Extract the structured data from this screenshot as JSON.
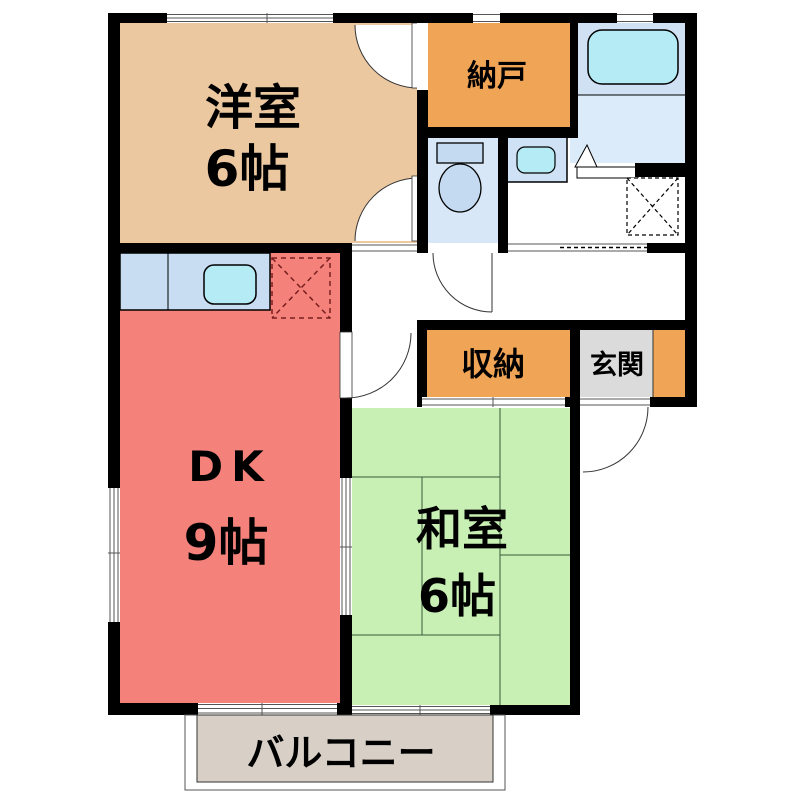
{
  "plan_title": "2DK apartment floor plan",
  "rooms": {
    "western": {
      "name": "洋室",
      "size": "6帖",
      "color": "#ecc8a1"
    },
    "storeroom": {
      "name": "納戸",
      "color": "#f0a456"
    },
    "dk": {
      "name": "DK",
      "size": "9帖",
      "color": "#f4827b"
    },
    "closet": {
      "name": "収納",
      "color": "#f0a456"
    },
    "entrance": {
      "name": "玄関",
      "color": "#dbdbdb"
    },
    "japanese": {
      "name": "和室",
      "size": "6帖",
      "color": "#c9f0b4"
    },
    "balcony": {
      "name": "バルコニー",
      "color": "#d8d0c7"
    }
  },
  "fixtures": {
    "bathtub": "bathtub",
    "toilet": "toilet",
    "washbasin": "washbasin",
    "kitchen_sink": "kitchen-sink-counter",
    "refrigerator_space": "refrigerator-space (dashed X)",
    "washing_machine_space": "washing-machine-space (dashed X)",
    "bath_door": "folding-bath-door"
  },
  "colors": {
    "wall": "#000000",
    "water_room_floor": "#d8e7f7",
    "bath_upper": "#cfe1f3",
    "bath_lower": "#dcebf9",
    "tub_water": "#b4ebf4",
    "counter_blue": "#c8dcf2",
    "fixture_blue": "#c3daf1",
    "balcony_gray": "#d8d0c7",
    "entrance_gray": "#dbdbdb"
  }
}
